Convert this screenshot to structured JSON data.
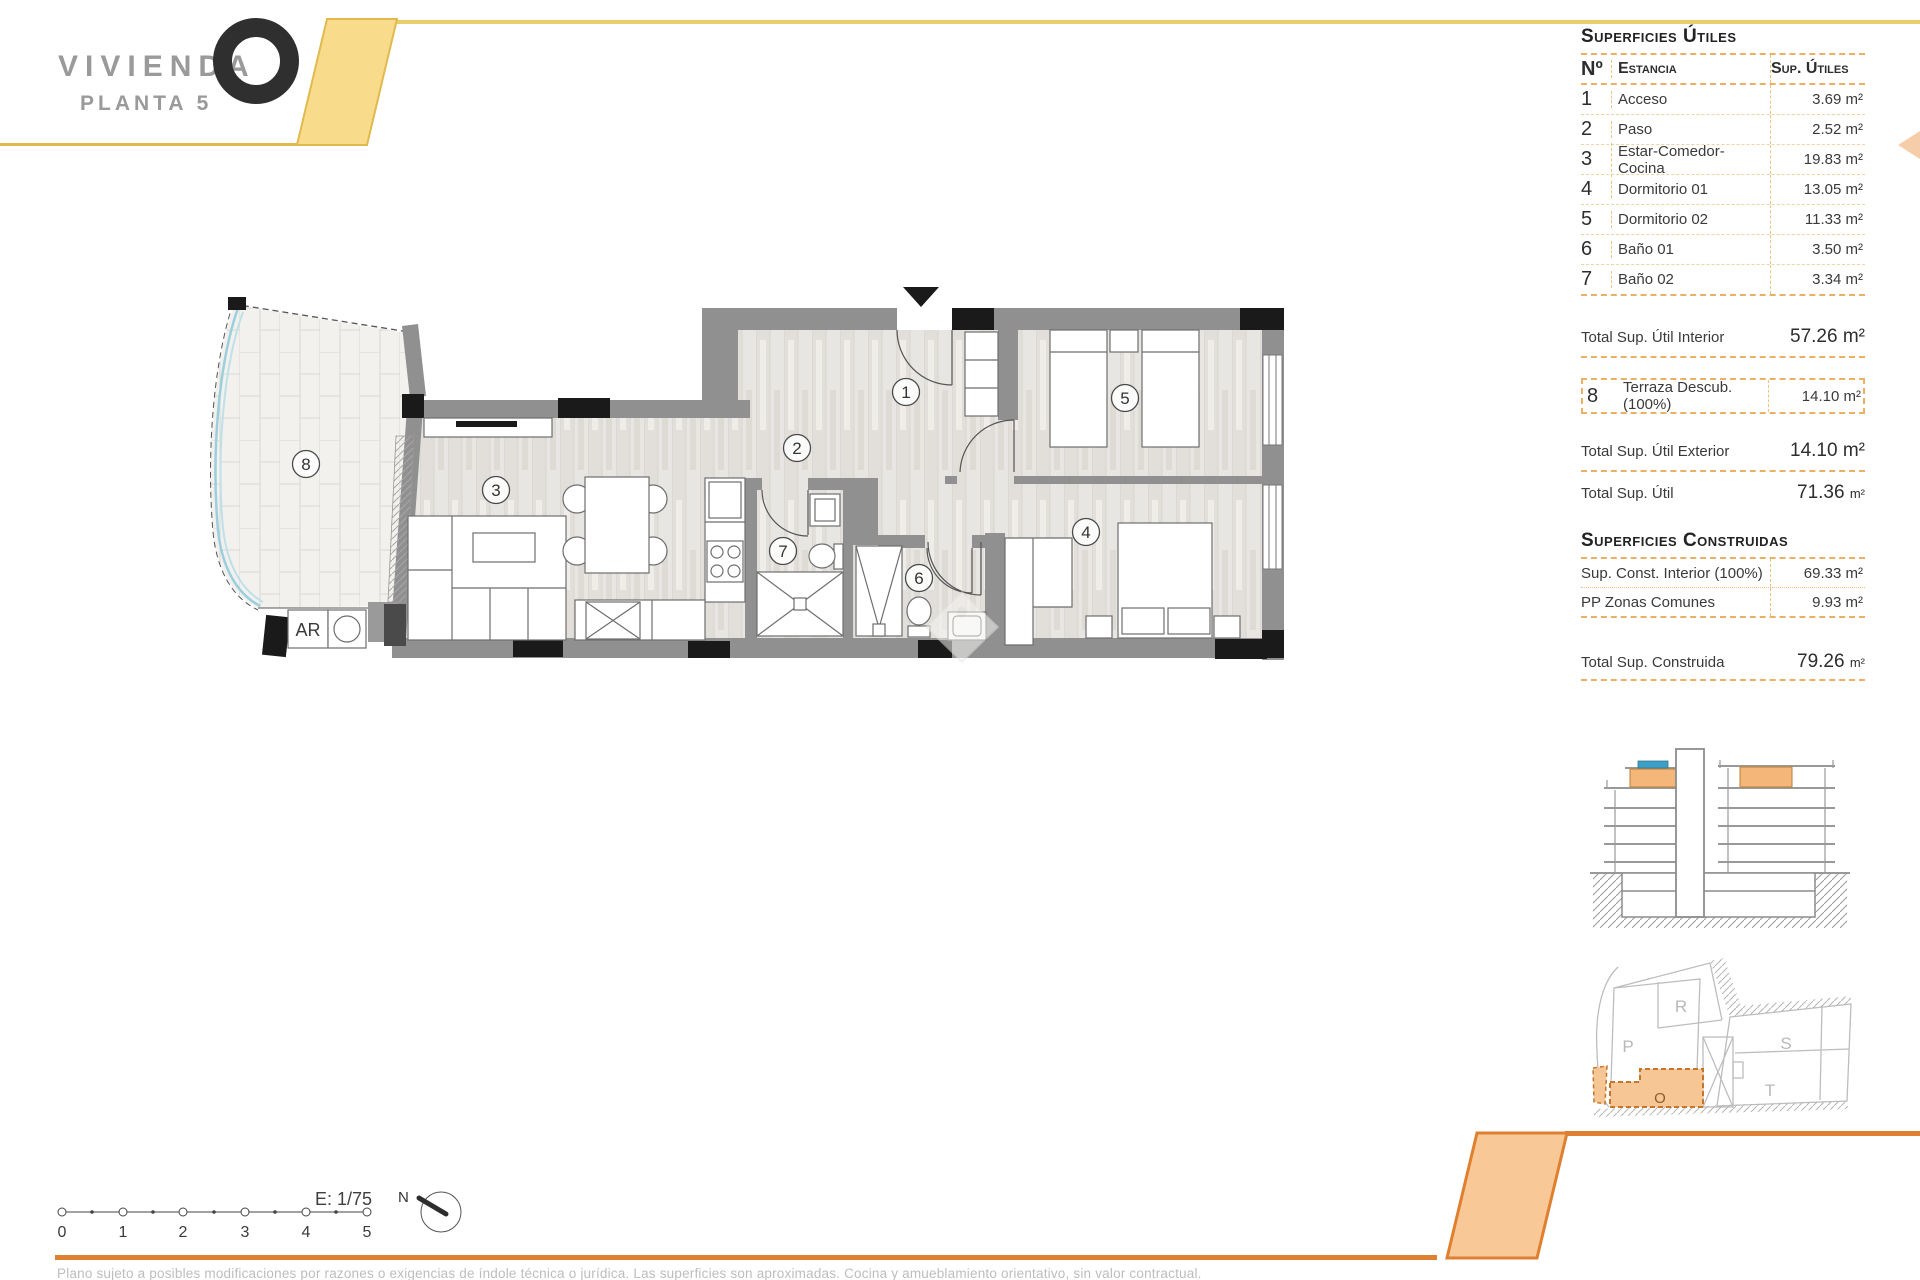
{
  "header": {
    "brand": "VIVIENDA",
    "floor_label": "PLANTA 5"
  },
  "surfaces_utiles": {
    "title": "Superficies Útiles",
    "col_no": "Nº",
    "col_room": "Estancia",
    "col_sup": "Sup. Útiles",
    "rows": [
      {
        "no": "1",
        "room": "Acceso",
        "sup": "3.69 m²"
      },
      {
        "no": "2",
        "room": "Paso",
        "sup": "2.52 m²"
      },
      {
        "no": "3",
        "room": "Estar-Comedor-Cocina",
        "sup": "19.83 m²"
      },
      {
        "no": "4",
        "room": "Dormitorio 01",
        "sup": "13.05 m²"
      },
      {
        "no": "5",
        "room": "Dormitorio 02",
        "sup": "11.33 m²"
      },
      {
        "no": "6",
        "room": "Baño 01",
        "sup": "3.50 m²"
      },
      {
        "no": "7",
        "room": "Baño 02",
        "sup": "3.34 m²"
      }
    ],
    "total_interior_label": "Total Sup. Útil Interior",
    "total_interior_value": "57.26 m²",
    "terrace_row": {
      "no": "8",
      "room": "Terraza Descub.(100%)",
      "sup": "14.10 m²"
    },
    "total_exterior_label": "Total Sup. Útil Exterior",
    "total_exterior_value": "14.10 m²",
    "total_label": "Total Sup. Útil",
    "total_value": "71.36",
    "total_unit": "m²"
  },
  "surfaces_construidas": {
    "title": "Superficies Construidas",
    "rows": [
      {
        "label": "Sup. Const. Interior (100%)",
        "value": "69.33 m²"
      },
      {
        "label": "PP Zonas Comunes",
        "value": "9.93 m²"
      }
    ],
    "total_label": "Total Sup. Construida",
    "total_value": "79.26",
    "total_unit": "m²"
  },
  "plan": {
    "rooms": [
      "1",
      "2",
      "3",
      "4",
      "5",
      "6",
      "7",
      "8"
    ],
    "laundry_label": "AR"
  },
  "site_plan": {
    "units": [
      "P",
      "R",
      "S",
      "T"
    ],
    "highlight_unit": "O"
  },
  "scale": {
    "label": "E: 1/75",
    "north": "N",
    "ticks": [
      "0",
      "1",
      "2",
      "3",
      "4",
      "5"
    ]
  },
  "footer": {
    "disclaimer": "Plano sujeto a posibles modificaciones por razones o exigencias de índole técnica o jurídica. Las superficies son aproximadas. Cocina y amueblamiento orientativo, sin valor contractual."
  },
  "colors": {
    "accent_yellow": "#f8dc8c",
    "accent_yellow_line": "#e2b94e",
    "accent_orange": "#f9c897",
    "accent_orange_line": "#df8030",
    "table_dash": "#ebb066",
    "total_orange": "#eaa74c",
    "wall_gray": "#909090",
    "column_black": "#1a1a1a",
    "glass_blue": "#9ccfdd",
    "section_orange": "#f4b679",
    "section_blue": "#3e9fc4"
  }
}
